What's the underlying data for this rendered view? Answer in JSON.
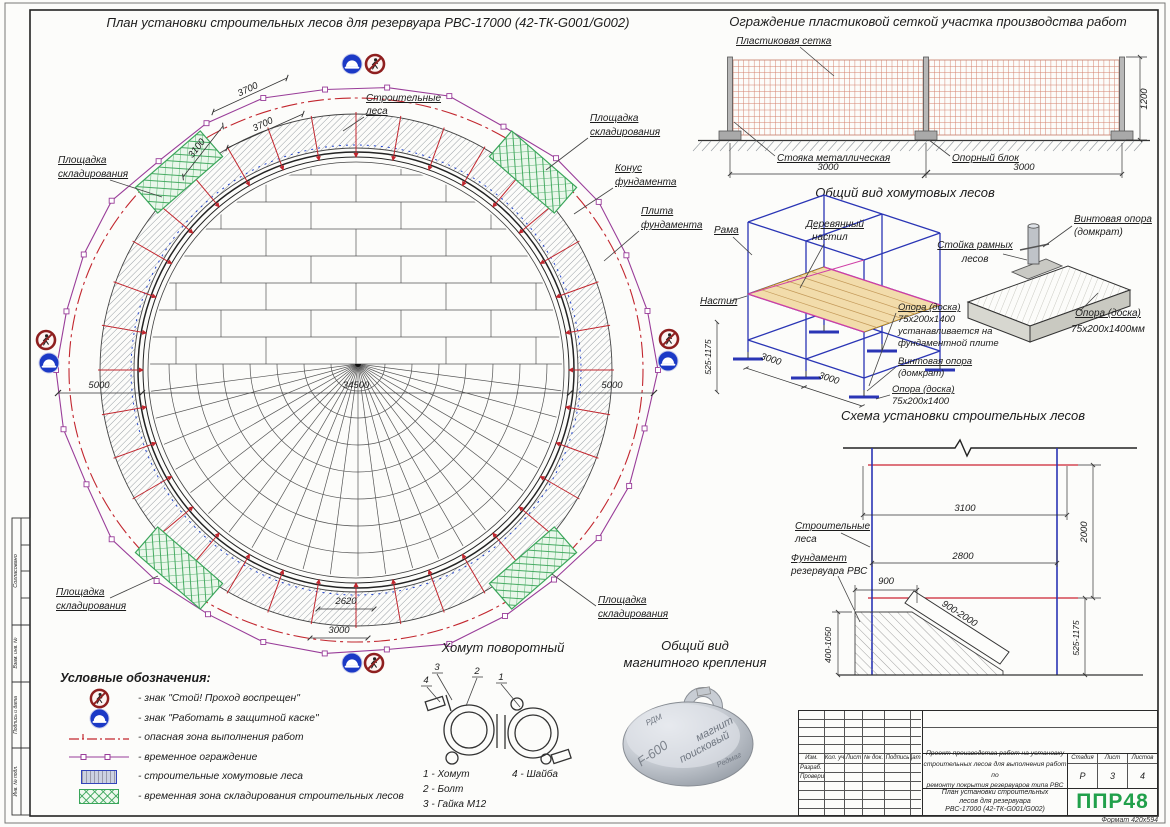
{
  "sheet": {
    "format": "Формат 420х594"
  },
  "plan": {
    "title": "План установки строительных лесов для резервуара РВС-17000 (42-ТК-G001/G002)",
    "scaffold1": "Строительные",
    "scaffold2": "леса",
    "storage1": "Площадка",
    "storage2": "складирования",
    "cone1": "Конус",
    "cone2": "фундамента",
    "slab1": "Плита",
    "slab2": "фундамента",
    "dim_3700": "3700",
    "dim_3100": "3100",
    "dim_5000": "5000",
    "dim_34500": "34500",
    "dim_2620": "2620",
    "dim_3000": "3000"
  },
  "fence": {
    "title": "Ограждение пластиковой сеткой участка производства работ",
    "mesh_label": "Пластиковая сетка",
    "post_label": "Стояка металлическая",
    "block_label": "Опорный блок",
    "dim_span1": "3000",
    "dim_span2": "3000",
    "dim_height": "1200"
  },
  "scaffold_view": {
    "title": "Общий вид хомутовых лесов",
    "frame": "Рама",
    "deck1": "Деревянный",
    "deck2": "настил",
    "deck_side": "Настил",
    "note1": "Опора (доска)",
    "note2": "75х200х1400",
    "note3": "устанавливается на",
    "note4": "фундаментной плите",
    "jack1": "Винтовая опора",
    "jack2": "(домкрат)",
    "board1": "Опора (доска)",
    "board2": "75х200х1400",
    "dim_bay1": "3000",
    "dim_bay2": "3000",
    "dim_height": "525-1175"
  },
  "jack_detail": {
    "jack1": "Винтовая опора",
    "jack2": "(домкрат)",
    "stand1": "Стойка рамных",
    "stand2": "лесов",
    "board1": "Опора (доска)",
    "board2": "75х200х1400мм"
  },
  "scheme": {
    "title": "Схема установки строительных лесов",
    "scaffold1": "Строительные",
    "scaffold2": "леса",
    "foundation1": "Фундамент",
    "foundation2": "резервуара РВС",
    "dim_3100": "3100",
    "dim_2800": "2800",
    "dim_900": "900",
    "dim_2000": "2000",
    "dim_900_2000": "900-2000",
    "dim_400_1050": "400-1050",
    "dim_525_1175": "525-1175"
  },
  "clamp": {
    "title": "Хомут поворотный",
    "n1": "1",
    "n2": "2",
    "n3": "3",
    "n4": "4",
    "part1": "1 - Хомут",
    "part2": "2 - Болт",
    "part3": "3 - Гайка М12",
    "part4": "4 - Шайба"
  },
  "magnet": {
    "title1": "Общий вид",
    "title2": "магнитного крепления",
    "eng_rdm": "РДМ",
    "eng1": "магнит",
    "eng2": "поисковый",
    "eng3": "F-600",
    "eng4": "Редмаг"
  },
  "legend": {
    "title": "Условные обозначения:",
    "items": [
      "- знак \"Стой! Проход воспрещен\"",
      "- знак \"Работать в защитной каске\"",
      "- опасная зона выполнения работ",
      "- временное ограждение",
      "- строительные хомутовые леса",
      "- временная зона складирования строительных лесов"
    ]
  },
  "stamp": {
    "h_izm": "Изм.",
    "h_kol": "Кол. уч",
    "h_list": "Лист",
    "h_doc": "№ док.",
    "h_sign": "Подпись",
    "h_date": "Дата",
    "r_dev": "Разраб.",
    "r_check": "Проверил",
    "project1": "Проект производства работ на установку",
    "project2": "строительных лесов для выполнения работ по",
    "project3": "ремонту покрытия резервуаров типа РВС",
    "doc1": "План установки строительных",
    "doc2": "лесов для резервуара",
    "doc3": "РВС-17000 (42-ТК-G001/G002)",
    "stage_h": "Стадия",
    "list_h": "Лист",
    "sheets_h": "Листов",
    "stage": "Р",
    "list": "3",
    "sheets": "4",
    "logo": "ППР48"
  },
  "margin": {
    "f1": "Согласовано",
    "f2": "Взам. инв. №",
    "f3": "Подпись и дата",
    "f4": "Инв. № подл."
  }
}
